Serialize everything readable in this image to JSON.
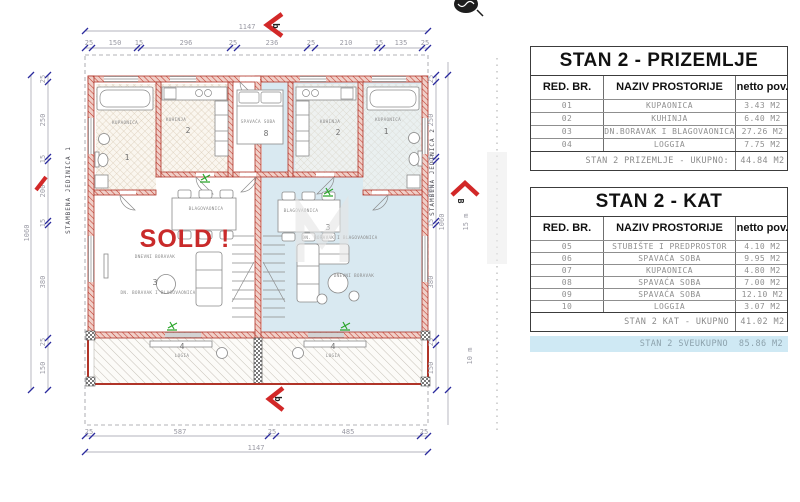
{
  "plan": {
    "sold_label": "SOLD !",
    "unit_left": "STAMBENA JEDINICA 1",
    "unit_right": "STAMBENA JEDINICA 2",
    "rooms": {
      "bath_name": "KUPAONICA",
      "bath_no": "1",
      "kitchen_name": "KUHINJA",
      "kitchen_no": "2",
      "living_name": "DN. BORAVAK I BLAGOVAONICA",
      "living_no": "3",
      "loggia_name": "LOGIA",
      "loggia_no": "4",
      "dining_label": "BLAGOVAONICA",
      "sitting_label": "DNEVNI BORAVAK",
      "center_room_name": "SPAVAĆA SOBA",
      "center_room_no": "8"
    },
    "dims": {
      "top_overall": "1147",
      "top_segments": [
        "25",
        "150",
        "15",
        "296",
        "25",
        "236",
        "25",
        "210",
        "15",
        "135",
        "25"
      ],
      "bottom_overall": "1147",
      "bottom_segments": [
        "25",
        "587",
        "25",
        "485",
        "25"
      ],
      "side_overall": "1060",
      "side_segments": [
        "25",
        "250",
        "15",
        "200",
        "15",
        "380",
        "25",
        "150"
      ],
      "note_upper": "15 m",
      "note_lower": "10 m"
    },
    "markers": {
      "top": "b",
      "bottom": "b",
      "right": "B"
    },
    "colors": {
      "wall": "#b03428",
      "sold": "#c92a2a",
      "unit2_floor": "#d9e9f1",
      "dim_tick": "#2b2b9e",
      "highlight_row": "#cfe9f4"
    }
  },
  "tables": [
    {
      "title": "STAN 2 - PRIZEMLJE",
      "columns": [
        "RED. BR.",
        "NAZIV PROSTORIJE",
        "netto pov."
      ],
      "rows": [
        [
          "01",
          "KUPAONICA",
          "3.43 M2"
        ],
        [
          "02",
          "KUHINJA",
          "6.40 M2"
        ],
        [
          "03",
          "DN.BORAVAK I BLAGOVAONICA",
          "27.26 M2"
        ],
        [
          "04",
          "LOGGIA",
          "7.75 M2"
        ]
      ],
      "footer": {
        "label": "STAN 2 PRIZEMLJE - UKUPNO:",
        "value": "44.84 M2"
      }
    },
    {
      "title": "STAN 2 - KAT",
      "columns": [
        "RED. BR.",
        "NAZIV PROSTORIJE",
        "netto pov."
      ],
      "rows": [
        [
          "05",
          "STUBIŠTE I PREDPROSTOR",
          "4.10 M2"
        ],
        [
          "06",
          "SPAVAĆA SOBA",
          "9.95 M2"
        ],
        [
          "07",
          "KUPAONICA",
          "4.80 M2"
        ],
        [
          "08",
          "SPAVAĆA SOBA",
          "7.00 M2"
        ],
        [
          "09",
          "SPAVAĆA SOBA",
          "12.10 M2"
        ],
        [
          "10",
          "LOGGIA",
          "3.07 M2"
        ]
      ],
      "footer": {
        "label": "STAN 2 KAT - UKUPNO",
        "value": "41.02 M2"
      },
      "grand_total": {
        "label": "STAN 2 SVEUKUPNO",
        "value": "85.86 M2"
      }
    }
  ]
}
